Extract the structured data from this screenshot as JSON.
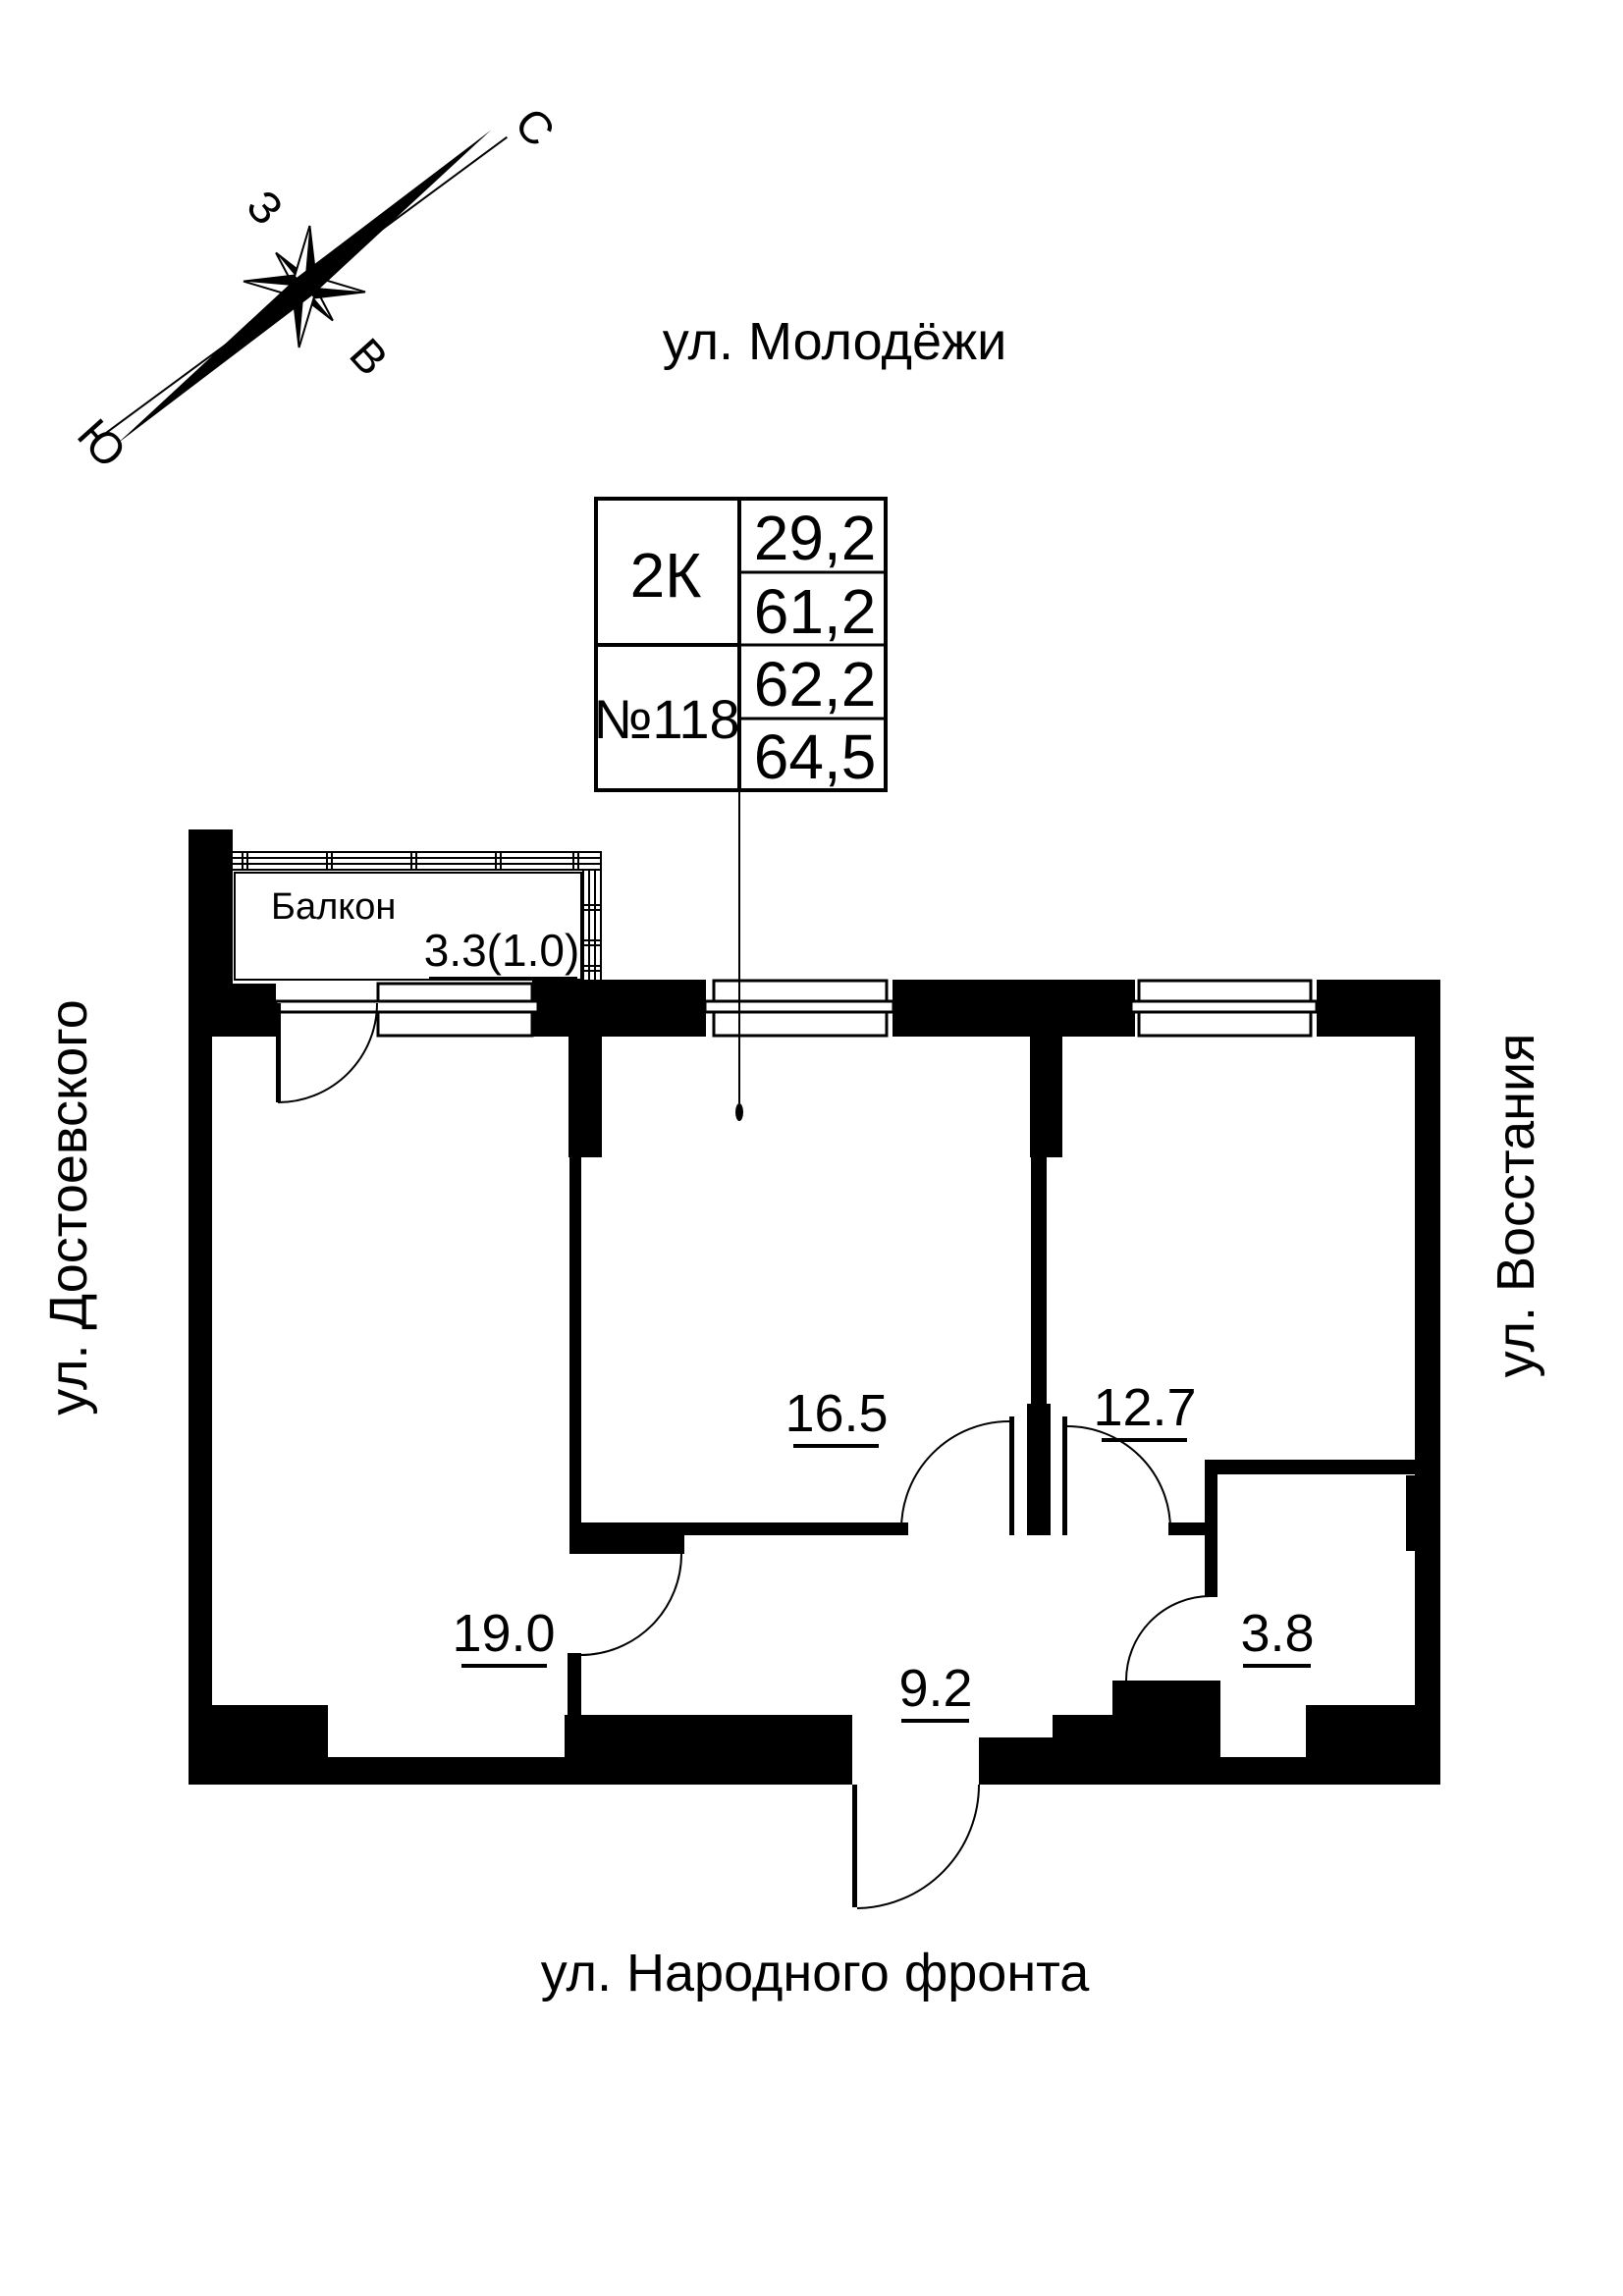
{
  "streets": {
    "top": "ул. Молодёжи",
    "left": "ул. Достоевского",
    "right": "ул. Восстания",
    "bottom": "ул. Народного фронта"
  },
  "compass": {
    "north": "С",
    "south": "Ю",
    "west": "З",
    "east": "В"
  },
  "info_table": {
    "type": "2К",
    "number": "№118",
    "values": [
      "29,2",
      "61,2",
      "62,2",
      "64,5"
    ]
  },
  "rooms": {
    "balcony_name": "Балкон",
    "balcony_area": "3.3(1.0)",
    "room1_area": "19.0",
    "room2_area": "16.5",
    "room3_area": "12.7",
    "hall_area": "9.2",
    "bath_area": "3.8"
  }
}
